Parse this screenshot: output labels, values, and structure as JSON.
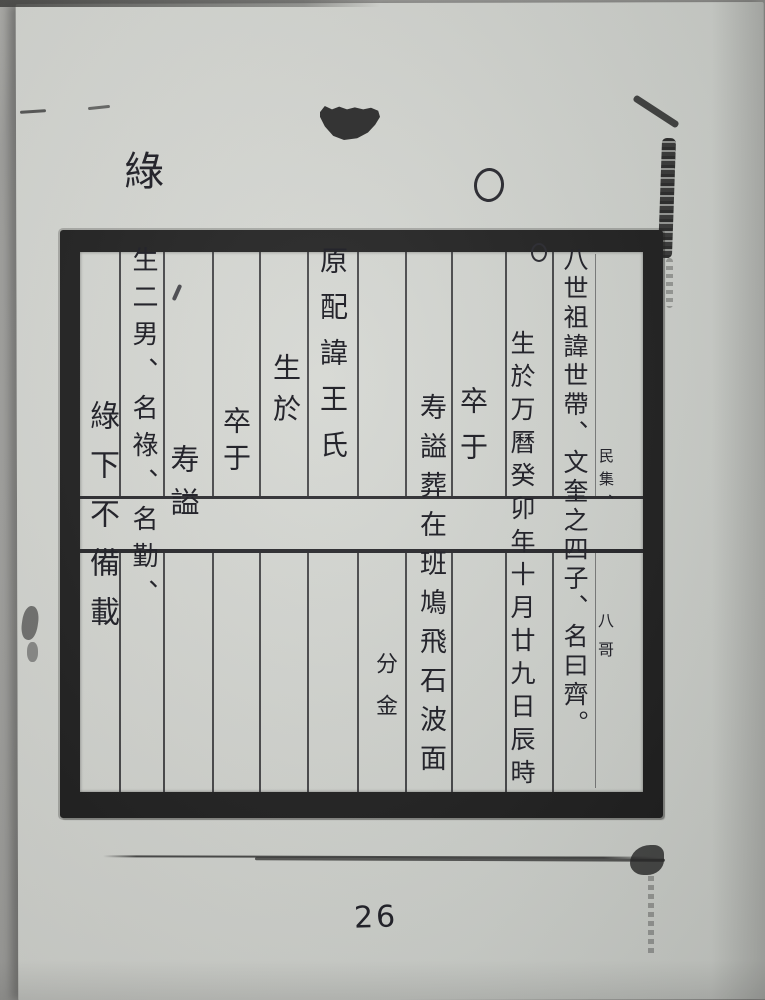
{
  "scan": {
    "top_left_character": "綠",
    "page_number": "26",
    "margin_circle_mark": "○",
    "grid_circle_mark": "○"
  },
  "grid": {
    "columns": [
      {
        "name": "generation-heading",
        "text": "八世祖諱世帶、文奎之四子、名曰齊。",
        "note_upper": "民集、",
        "note_lower": "八哥"
      },
      {
        "name": "birth-record",
        "text": "生於万曆癸卯年十月廿九日辰時"
      },
      {
        "name": "death-record",
        "text": "卒于"
      },
      {
        "name": "burial-record",
        "text": "寿謚葬在班鳩飛石波面"
      },
      {
        "name": "bearing-note",
        "text": "分金"
      },
      {
        "name": "spouse-record",
        "text": "原配諱王氏"
      },
      {
        "name": "spouse-birth",
        "text": "生於"
      },
      {
        "name": "spouse-death",
        "text": "卒于"
      },
      {
        "name": "spouse-posthumous",
        "text": "寿謚"
      },
      {
        "name": "sons-record",
        "text": "生二男、名祿、名勤、"
      },
      {
        "name": "continuation-note",
        "text": "綠下不備載"
      }
    ]
  },
  "colors": {
    "paper": "#d3d5d0",
    "ink": "#26262d",
    "grid_border": "#1c1c1c",
    "backdrop": "#9c9c99"
  }
}
